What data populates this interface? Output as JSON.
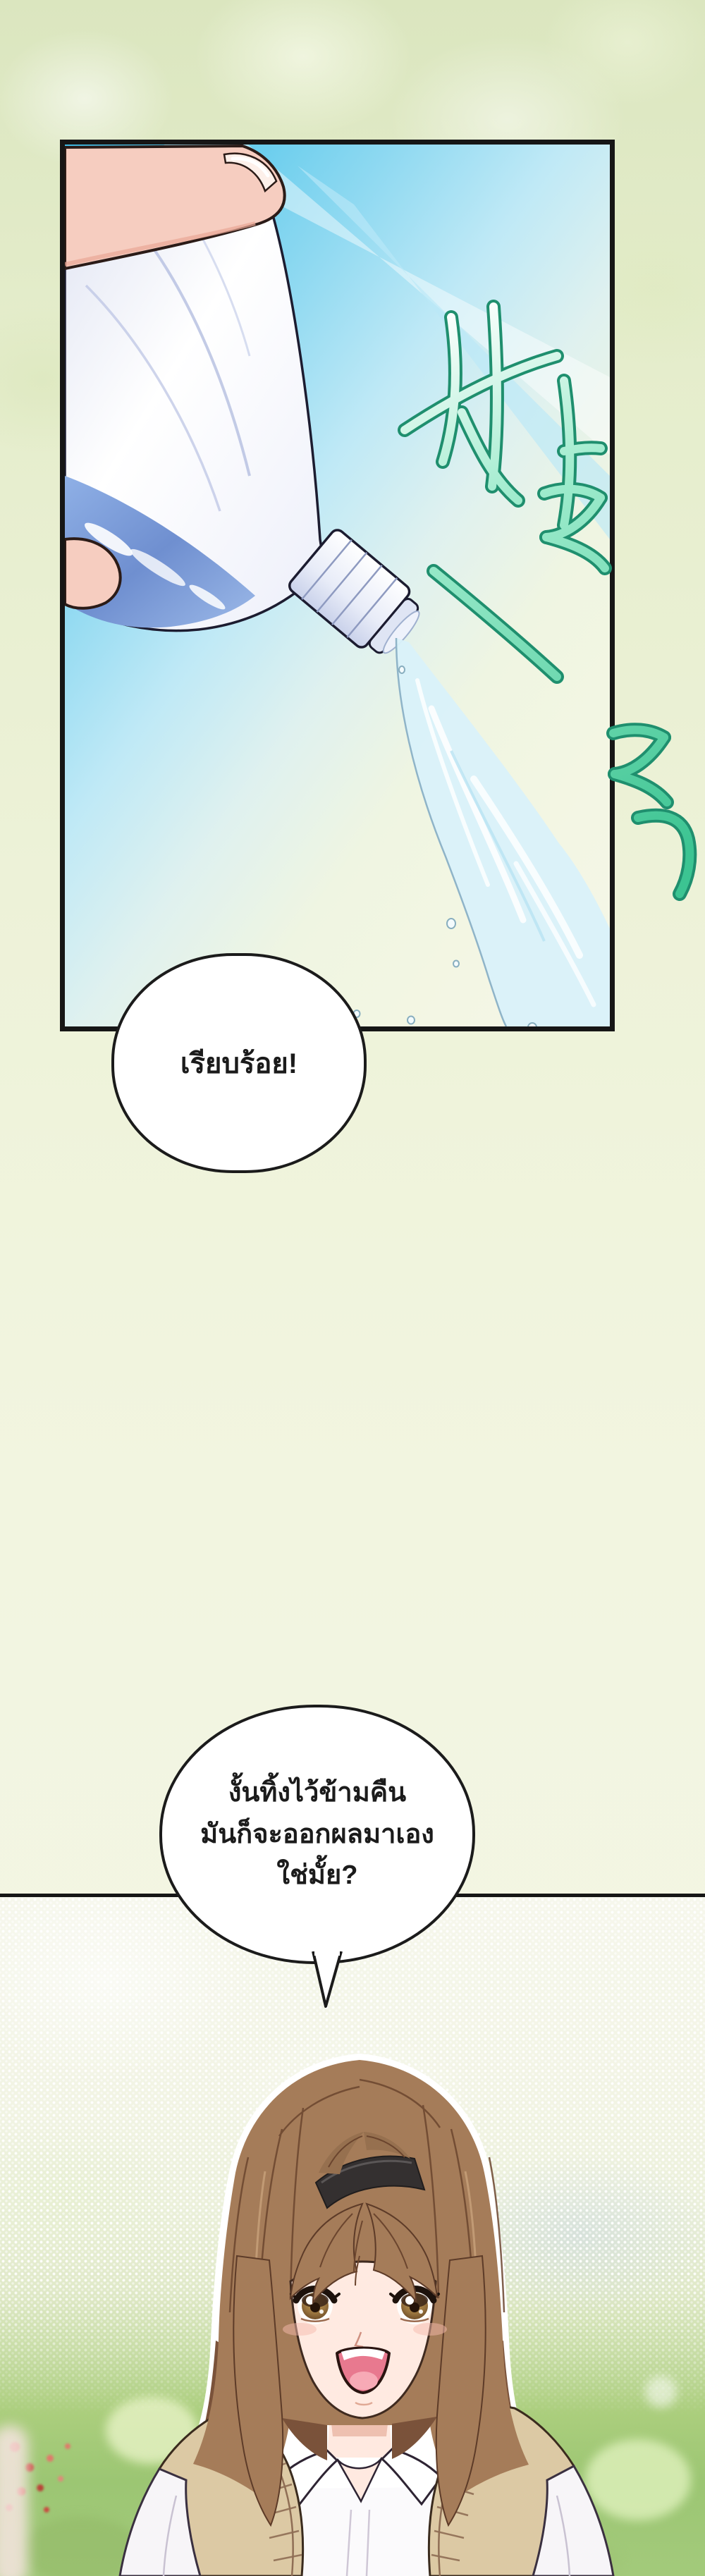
{
  "page": {
    "bg_top": "#dbe6bf",
    "bg_mid": "#eef3da",
    "bg_bottom": "#f4f6e6"
  },
  "panel": {
    "alt": "hand pouring water from a clear plastic bottle against a blue sky",
    "border_color": "#161616",
    "sky_blue": "#3fbce6",
    "bottle_water_blue": "#6f8fd0",
    "stream_blue": "#d9f1fa",
    "skin": "#f6cdc0"
  },
  "sfx": {
    "text": "촤르르륵",
    "fill": "#63d6ab",
    "outline": "#1f8f6e"
  },
  "bubble1": {
    "text": "เรียบร้อย!"
  },
  "bubble2": {
    "lines": [
      "งั้นทิ้งไว้ข้ามคืน",
      "มันก็จะออกผลมาเอง",
      "ใช่มั้ย?"
    ]
  },
  "divider": {
    "color": "#161616"
  },
  "character": {
    "alt": "smiling character with brown bob hair, black headband, white collared shirt and beige knit vest",
    "hair": "#a57c59",
    "hair_dark": "#6b452e",
    "headband": "#343030",
    "skin": "#ffeae1",
    "eye": "#8a6b3e",
    "vest": "#dcc9a4",
    "shirt": "#fbfafc",
    "mouth_inner": "#e8798f"
  },
  "scenery": {
    "grass": "#a3ca7b",
    "flower_red": "#d2554a",
    "halftone_dot": "#ffffff"
  }
}
